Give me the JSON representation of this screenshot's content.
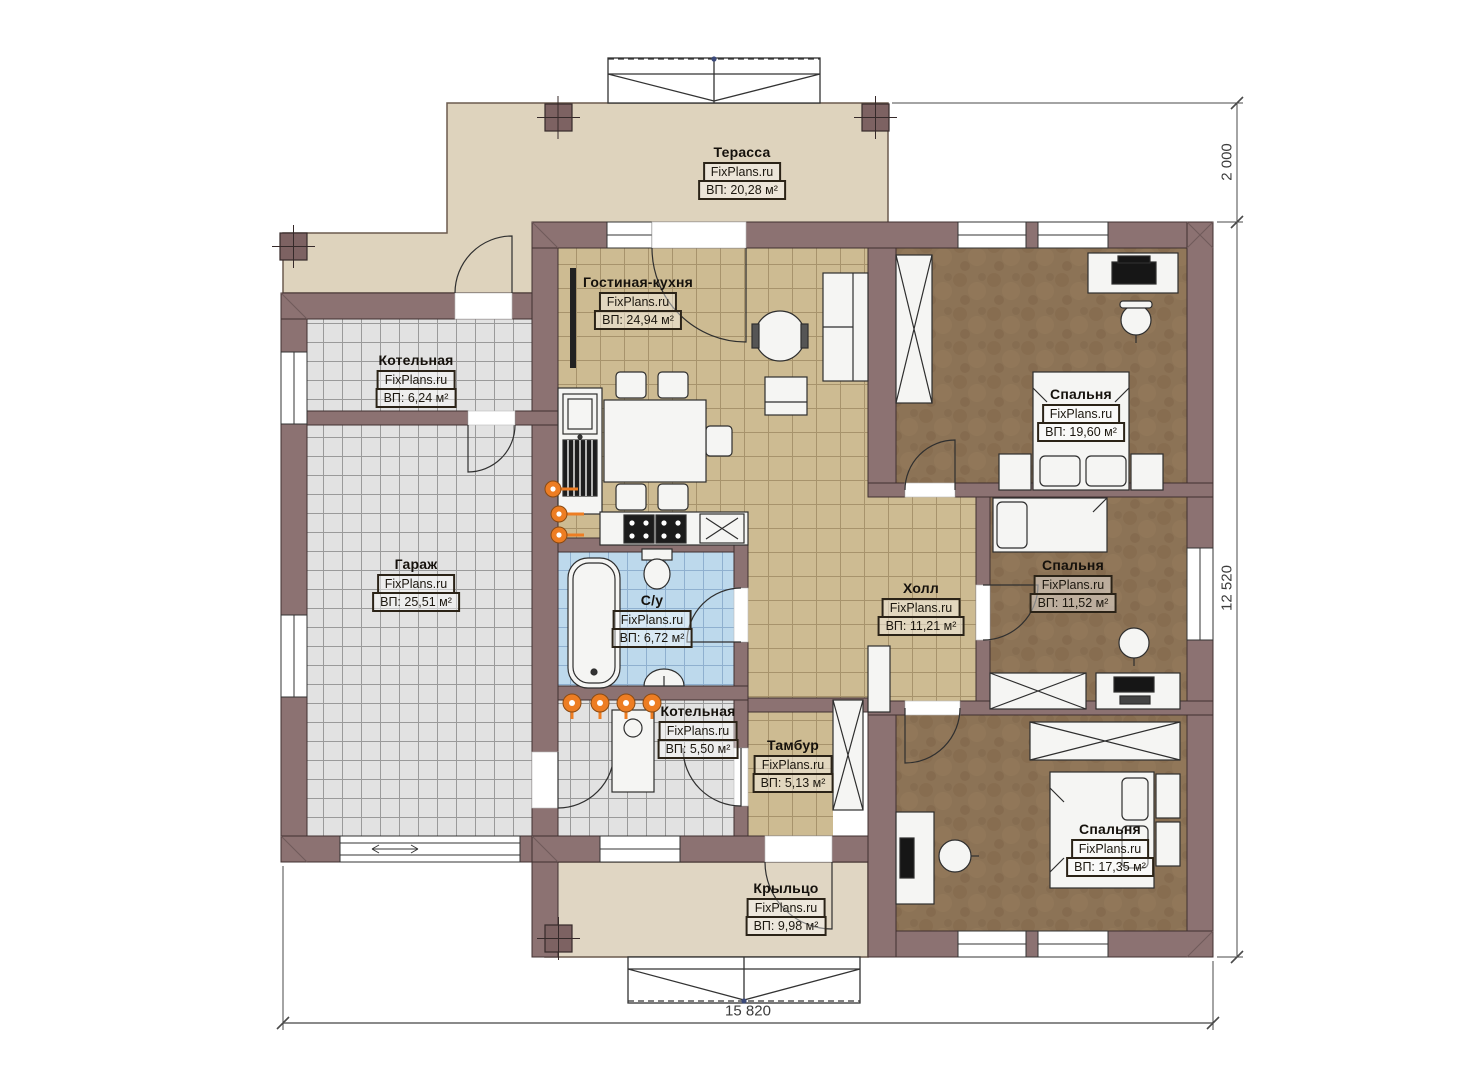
{
  "plan": {
    "brand_watermark": "FixPlans.ru",
    "rooms": [
      {
        "id": "terrace",
        "name": "Терасса",
        "watermark": "FixPlans.ru",
        "area": "ВП: 20,28 м²"
      },
      {
        "id": "living-kitchen",
        "name": "Гостиная-кухня",
        "watermark": "FixPlans.ru",
        "area": "ВП: 24,94 м²"
      },
      {
        "id": "boiler-top",
        "name": "Котельная",
        "watermark": "FixPlans.ru",
        "area": "ВП: 6,24 м²"
      },
      {
        "id": "garage",
        "name": "Гараж",
        "watermark": "FixPlans.ru",
        "area": "ВП: 25,51 м²"
      },
      {
        "id": "bathroom",
        "name": "С/у",
        "watermark": "FixPlans.ru",
        "area": "ВП: 6,72 м²"
      },
      {
        "id": "boiler-bottom",
        "name": "Котельная",
        "watermark": "FixPlans.ru",
        "area": "ВП: 5,50 м²"
      },
      {
        "id": "vestibule",
        "name": "Тамбур",
        "watermark": "FixPlans.ru",
        "area": "ВП: 5,13 м²"
      },
      {
        "id": "hall",
        "name": "Холл",
        "watermark": "FixPlans.ru",
        "area": "ВП: 11,21 м²"
      },
      {
        "id": "bedroom-1",
        "name": "Спальня",
        "watermark": "FixPlans.ru",
        "area": "ВП: 19,60 м²"
      },
      {
        "id": "bedroom-2",
        "name": "Спальня",
        "watermark": "FixPlans.ru",
        "area": "ВП: 11,52 м²"
      },
      {
        "id": "bedroom-3",
        "name": "Спальня",
        "watermark": "FixPlans.ru",
        "area": "ВП: 17,35 м²"
      },
      {
        "id": "porch",
        "name": "Крыльцо",
        "watermark": "FixPlans.ru",
        "area": "ВП: 9,98 м²"
      }
    ],
    "dimensions": {
      "bottom_width": "15 820",
      "right_height": "12 520",
      "terrace_depth": "2 000"
    },
    "colors": {
      "wall": "#8c7272",
      "wall_edge": "#403030",
      "terrace": "#ded3bd",
      "porch": "#e0d6c3",
      "tile_gray": "#e2e2e2",
      "tile_tan": "#cdbb92",
      "tile_blue": "#bdd9ec",
      "carpet": "#8c7356",
      "furniture": "#f5f5f3",
      "accent_orange": "#ed7d23",
      "dim_line": "#4a4a4a"
    },
    "icons": {
      "heating": "heating-valve-icon"
    }
  }
}
